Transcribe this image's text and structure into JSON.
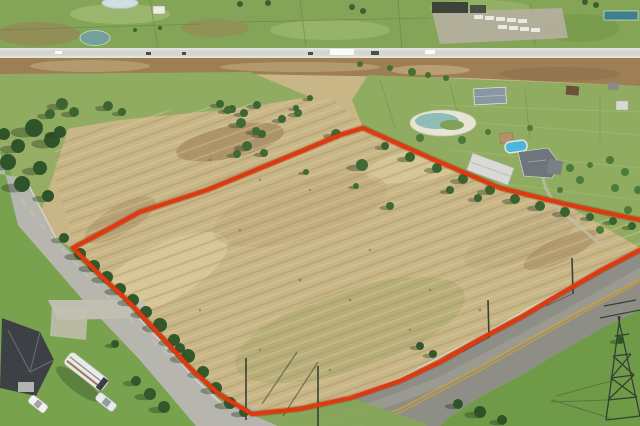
{
  "scene": {
    "subject": "aerial-drone-photo-of-land-parcel-with-red-boundary-outline"
  },
  "colors": {
    "field": "#c9b687",
    "fieldLight": "#ddcfa2",
    "fieldDark": "#b5a075",
    "fieldGreen": "#a3a469",
    "dirtPatch": "#a08257",
    "pasture": "#84a557",
    "pasture2": "#8fac60",
    "pastureLight": "#a8c27b",
    "pastureDark": "#6d9346",
    "fence": "#5e7f40",
    "lawn": "#79a24e",
    "lawn2": "#86a65a",
    "lawn3": "#6f9a48",
    "dirt": "#9d7e55",
    "hwy": "#d8d8d2",
    "road": "#b6b6af",
    "road2": "#8e8e86",
    "roadWorn": "#a5a49b",
    "gravel": "#c3bfb2",
    "yard": "#b3ae9d",
    "bldgDark": "#3c443a",
    "teal": "#3f7e8a",
    "pond1": "#cfe0e2",
    "pond2": "#74a09b",
    "deck": "#e8e4d4",
    "pondWater": "#8fbcb4",
    "island": "#7fa055",
    "pool": "#4ab8dc",
    "roofWhite": "#ecece6",
    "roof1": "#8a97a2",
    "roof2": "#6e757c",
    "roofDark": "#3d4145",
    "rv": "#e9e9e5",
    "boundary": "#dd3a10",
    "boundaryGlow": "#8a2407",
    "pylon": "#343f36",
    "pole": "#3a4234",
    "yellowLine": "#c8a23f",
    "whiteLine": "#ebebe4"
  },
  "boundary": {
    "points": "363,128 430,158 500,188 565,204 640,220 700,238 640,250 600,271 560,294 520,318 480,339 440,362 400,381 350,398 300,409 252,414 220,395 190,368 160,335 130,303 100,275 73,248 140,212 207,190 273,163 340,135",
    "clip_upper": "55,140 170,110 330,97 365,126 75,246 55,175"
  },
  "stamps": [
    {
      "into": "trees-left",
      "kind": "tree",
      "fill": "#2f5429",
      "shadow": true,
      "pts": [
        [
          34,
          128,
          9
        ],
        [
          52,
          140,
          8
        ],
        [
          18,
          146,
          7
        ],
        [
          8,
          162,
          8
        ],
        [
          40,
          168,
          7
        ],
        [
          22,
          184,
          8
        ],
        [
          48,
          196,
          6
        ],
        [
          60,
          132,
          6
        ],
        [
          4,
          134,
          6
        ]
      ]
    },
    {
      "into": "trees-midleft",
      "kind": "tree",
      "fill": "#3d6532",
      "shadow": true,
      "pts": [
        [
          62,
          104,
          6
        ],
        [
          74,
          112,
          5
        ],
        [
          50,
          114,
          5
        ],
        [
          108,
          106,
          5
        ],
        [
          122,
          112,
          4
        ],
        [
          220,
          104,
          4
        ],
        [
          232,
          109,
          4
        ],
        [
          244,
          113,
          4
        ],
        [
          257,
          105,
          4
        ],
        [
          282,
          119,
          4
        ],
        [
          296,
          108,
          3
        ],
        [
          262,
          134,
          4
        ],
        [
          310,
          98,
          3
        ]
      ]
    },
    {
      "into": "trees-dirt-edge",
      "kind": "tree",
      "fill": "#45702f",
      "shadow": false,
      "pts": [
        [
          390,
          68,
          3
        ],
        [
          412,
          72,
          4
        ],
        [
          428,
          75,
          3
        ],
        [
          446,
          78,
          3
        ],
        [
          360,
          64,
          3
        ]
      ]
    },
    {
      "into": "trees-roadline",
      "kind": "tree",
      "fill": "#33582b",
      "shadow": true,
      "pts": [
        [
          80,
          254,
          6
        ],
        [
          94,
          266,
          6
        ],
        [
          107,
          277,
          6
        ],
        [
          120,
          289,
          6
        ],
        [
          133,
          300,
          6
        ],
        [
          146,
          312,
          6
        ],
        [
          160,
          325,
          7
        ],
        [
          174,
          340,
          6
        ],
        [
          188,
          356,
          7
        ],
        [
          203,
          372,
          6
        ],
        [
          216,
          388,
          6
        ],
        [
          230,
          403,
          6
        ],
        [
          244,
          412,
          5
        ],
        [
          64,
          238,
          5
        ],
        [
          180,
          348,
          5
        ],
        [
          420,
          346,
          4
        ],
        [
          433,
          354,
          4
        ]
      ]
    },
    {
      "into": "trees-parcel",
      "kind": "tree",
      "fill": "#3f6a33",
      "shadow": true,
      "pts": [
        [
          228,
          110,
          4
        ],
        [
          241,
          123,
          5
        ],
        [
          256,
          131,
          4
        ],
        [
          247,
          146,
          5
        ],
        [
          237,
          154,
          4
        ],
        [
          264,
          153,
          4
        ],
        [
          298,
          113,
          4
        ],
        [
          336,
          134,
          5
        ],
        [
          362,
          165,
          6
        ],
        [
          306,
          172,
          3
        ],
        [
          390,
          206,
          4
        ],
        [
          356,
          186,
          3
        ]
      ]
    },
    {
      "into": "trees-ne-row",
      "kind": "tree",
      "fill": "#3a6330",
      "shadow": true,
      "pts": [
        [
          385,
          146,
          4
        ],
        [
          410,
          157,
          5
        ],
        [
          437,
          168,
          5
        ],
        [
          463,
          179,
          5
        ],
        [
          490,
          190,
          5
        ],
        [
          515,
          199,
          5
        ],
        [
          540,
          206,
          5
        ],
        [
          565,
          212,
          5
        ],
        [
          590,
          217,
          4
        ],
        [
          613,
          221,
          4
        ],
        [
          632,
          226,
          4
        ],
        [
          450,
          190,
          4
        ],
        [
          478,
          198,
          4
        ]
      ]
    },
    {
      "into": "trees-pasture-right",
      "kind": "bush",
      "fill": "#4c7a39",
      "shadow": false,
      "pts": [
        [
          580,
          180,
          4
        ],
        [
          615,
          188,
          4
        ],
        [
          560,
          190,
          3
        ],
        [
          600,
          230,
          4
        ],
        [
          628,
          210,
          4
        ],
        [
          570,
          168,
          4
        ],
        [
          590,
          165,
          3
        ],
        [
          420,
          138,
          4
        ],
        [
          462,
          140,
          4
        ],
        [
          488,
          132,
          3
        ],
        [
          530,
          128,
          3
        ],
        [
          610,
          160,
          4
        ],
        [
          625,
          172,
          4
        ],
        [
          638,
          190,
          4
        ]
      ]
    },
    {
      "into": "trees-bottom-right",
      "kind": "tree",
      "fill": "#2f5227",
      "shadow": true,
      "pts": [
        [
          458,
          404,
          5
        ],
        [
          480,
          412,
          6
        ],
        [
          502,
          420,
          5
        ],
        [
          620,
          340,
          4
        ]
      ]
    },
    {
      "into": "trees-lawn",
      "kind": "tree",
      "fill": "#34582c",
      "shadow": true,
      "pts": [
        [
          150,
          394,
          6
        ],
        [
          164,
          407,
          6
        ],
        [
          136,
          381,
          5
        ],
        [
          115,
          344,
          4
        ]
      ]
    },
    {
      "into": "trees-top-band",
      "kind": "tree",
      "fill": "#3c6031",
      "shadow": false,
      "pts": [
        [
          352,
          7,
          3
        ],
        [
          363,
          11,
          3
        ],
        [
          596,
          5,
          3
        ],
        [
          585,
          2,
          3
        ],
        [
          268,
          3,
          3
        ],
        [
          240,
          4,
          3
        ],
        [
          160,
          28,
          2
        ],
        [
          135,
          30,
          2
        ]
      ]
    },
    {
      "into": "highway-vehicles",
      "kind": "vehicle-dark",
      "fill": "#4a4d50",
      "pts": [
        [
          146,
          52,
          5,
          3
        ],
        [
          182,
          52,
          4,
          3
        ],
        [
          308,
          52,
          5,
          3
        ],
        [
          371,
          51,
          8,
          4
        ]
      ]
    },
    {
      "into": "highway-vehicles",
      "kind": "vehicle-light",
      "fill": "#fafaf7",
      "pts": [
        [
          330,
          49,
          24,
          6
        ],
        [
          425,
          50,
          10,
          4
        ],
        [
          55,
          51,
          7,
          3
        ]
      ]
    },
    {
      "into": "truck-yard-trailers",
      "kind": "truck-trailer",
      "fill": "#e9e9e3",
      "pts": [
        [
          474,
          15,
          9,
          4
        ],
        [
          485,
          16,
          9,
          4
        ],
        [
          496,
          17,
          9,
          4
        ],
        [
          507,
          18,
          9,
          4
        ],
        [
          518,
          19,
          9,
          4
        ],
        [
          498,
          25,
          9,
          4
        ],
        [
          509,
          26,
          9,
          4
        ],
        [
          520,
          27,
          9,
          4
        ],
        [
          531,
          28,
          9,
          4
        ]
      ]
    },
    {
      "into": "field-scrub",
      "kind": "scrub",
      "fill": "#7a6a45",
      "opacity": "0.6",
      "pts": [
        [
          210,
          160,
          1.5
        ],
        [
          260,
          180,
          1.2
        ],
        [
          180,
          200,
          1.4
        ],
        [
          310,
          190,
          1.2
        ],
        [
          240,
          230,
          1.3
        ],
        [
          370,
          250,
          1.2
        ],
        [
          300,
          280,
          1.5
        ],
        [
          430,
          290,
          1.2
        ],
        [
          200,
          310,
          1.3
        ],
        [
          480,
          310,
          1.4
        ],
        [
          260,
          350,
          1.2
        ],
        [
          330,
          370,
          1.3
        ],
        [
          350,
          300,
          1.4
        ],
        [
          410,
          330,
          1.2
        ]
      ]
    }
  ]
}
